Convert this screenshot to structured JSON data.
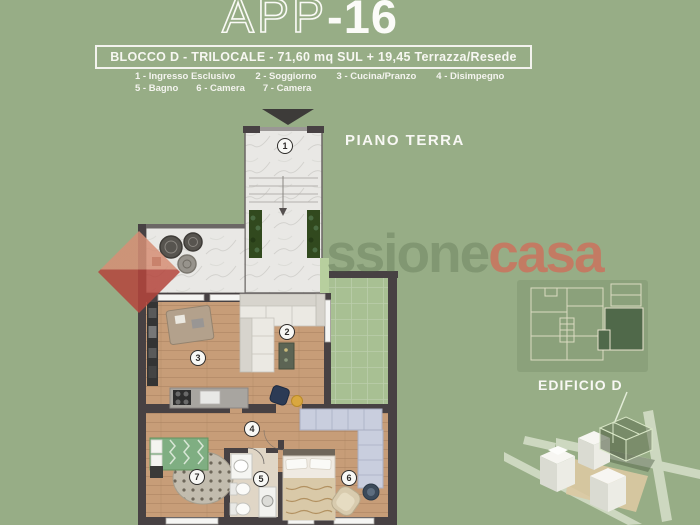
{
  "header": {
    "title_prefix": "APP",
    "title_suffix": "-16",
    "subtitle": "BLOCCO D - TRILOCALE - 71,60 mq SUL + 19,45 Terrazza/Resede",
    "legend_row1": [
      "1 - Ingresso Esclusivo",
      "2 - Soggiorno",
      "3 - Cucina/Pranzo",
      "4 - Disimpegno"
    ],
    "legend_row2": [
      "5 - Bagno",
      "6 - Camera",
      "7 - Camera"
    ]
  },
  "floorplan": {
    "floor_label": "PIANO TERRA",
    "rooms": [
      {
        "num": "1",
        "label": "Ingresso Esclusivo"
      },
      {
        "num": "2",
        "label": "Soggiorno"
      },
      {
        "num": "3",
        "label": "Cucina/Pranzo"
      },
      {
        "num": "4",
        "label": "Disimpegno"
      },
      {
        "num": "5",
        "label": "Bagno"
      },
      {
        "num": "6",
        "label": "Camera"
      },
      {
        "num": "7",
        "label": "Camera"
      }
    ]
  },
  "watermark": {
    "faint_text": "ssione",
    "accent_text": "casa"
  },
  "site_panel": {
    "building_label": "EDIFICIO D"
  },
  "colors": {
    "background": "#97ad86",
    "text": "#f7f7f2",
    "watermark_accent": "#c7766a",
    "walls": "#474143",
    "wood_floor": "#c79d78",
    "marble": "#e9e8e5",
    "garden": "#a8c093",
    "highlight_unit": "#50694a"
  }
}
